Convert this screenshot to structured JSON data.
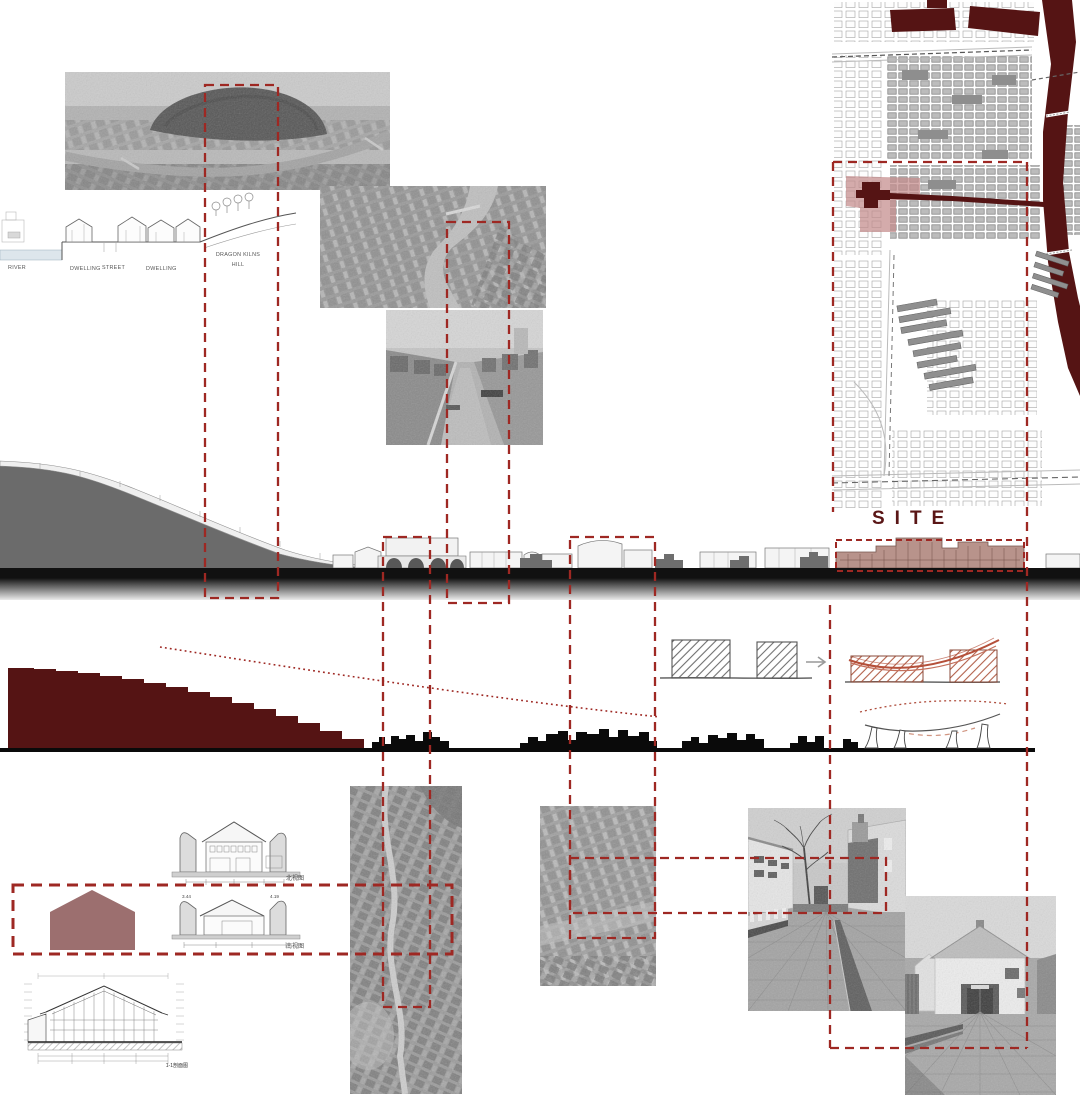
{
  "section": {
    "river": "RIVER",
    "dwelling_left": "DWELLING",
    "street": "STREET",
    "dwelling_right": "DWELLING",
    "hill_line1": "DRAGON KILNS",
    "hill_line2": "HILL"
  },
  "site": {
    "label": "SITE"
  },
  "elevations": {
    "top_label": "北视图",
    "bottom_label": "南视图",
    "dim_left": "3.44",
    "dim_right": "4.19"
  },
  "tech_section": {
    "label": "1-1剖面图"
  },
  "colors": {
    "accent_red": "#9E2823",
    "maroon": "#551414",
    "site_fill": "#B28A82",
    "house_fill": "#9C6F6F",
    "hill_gray": "#6B6B6B",
    "ink": "#111111"
  }
}
